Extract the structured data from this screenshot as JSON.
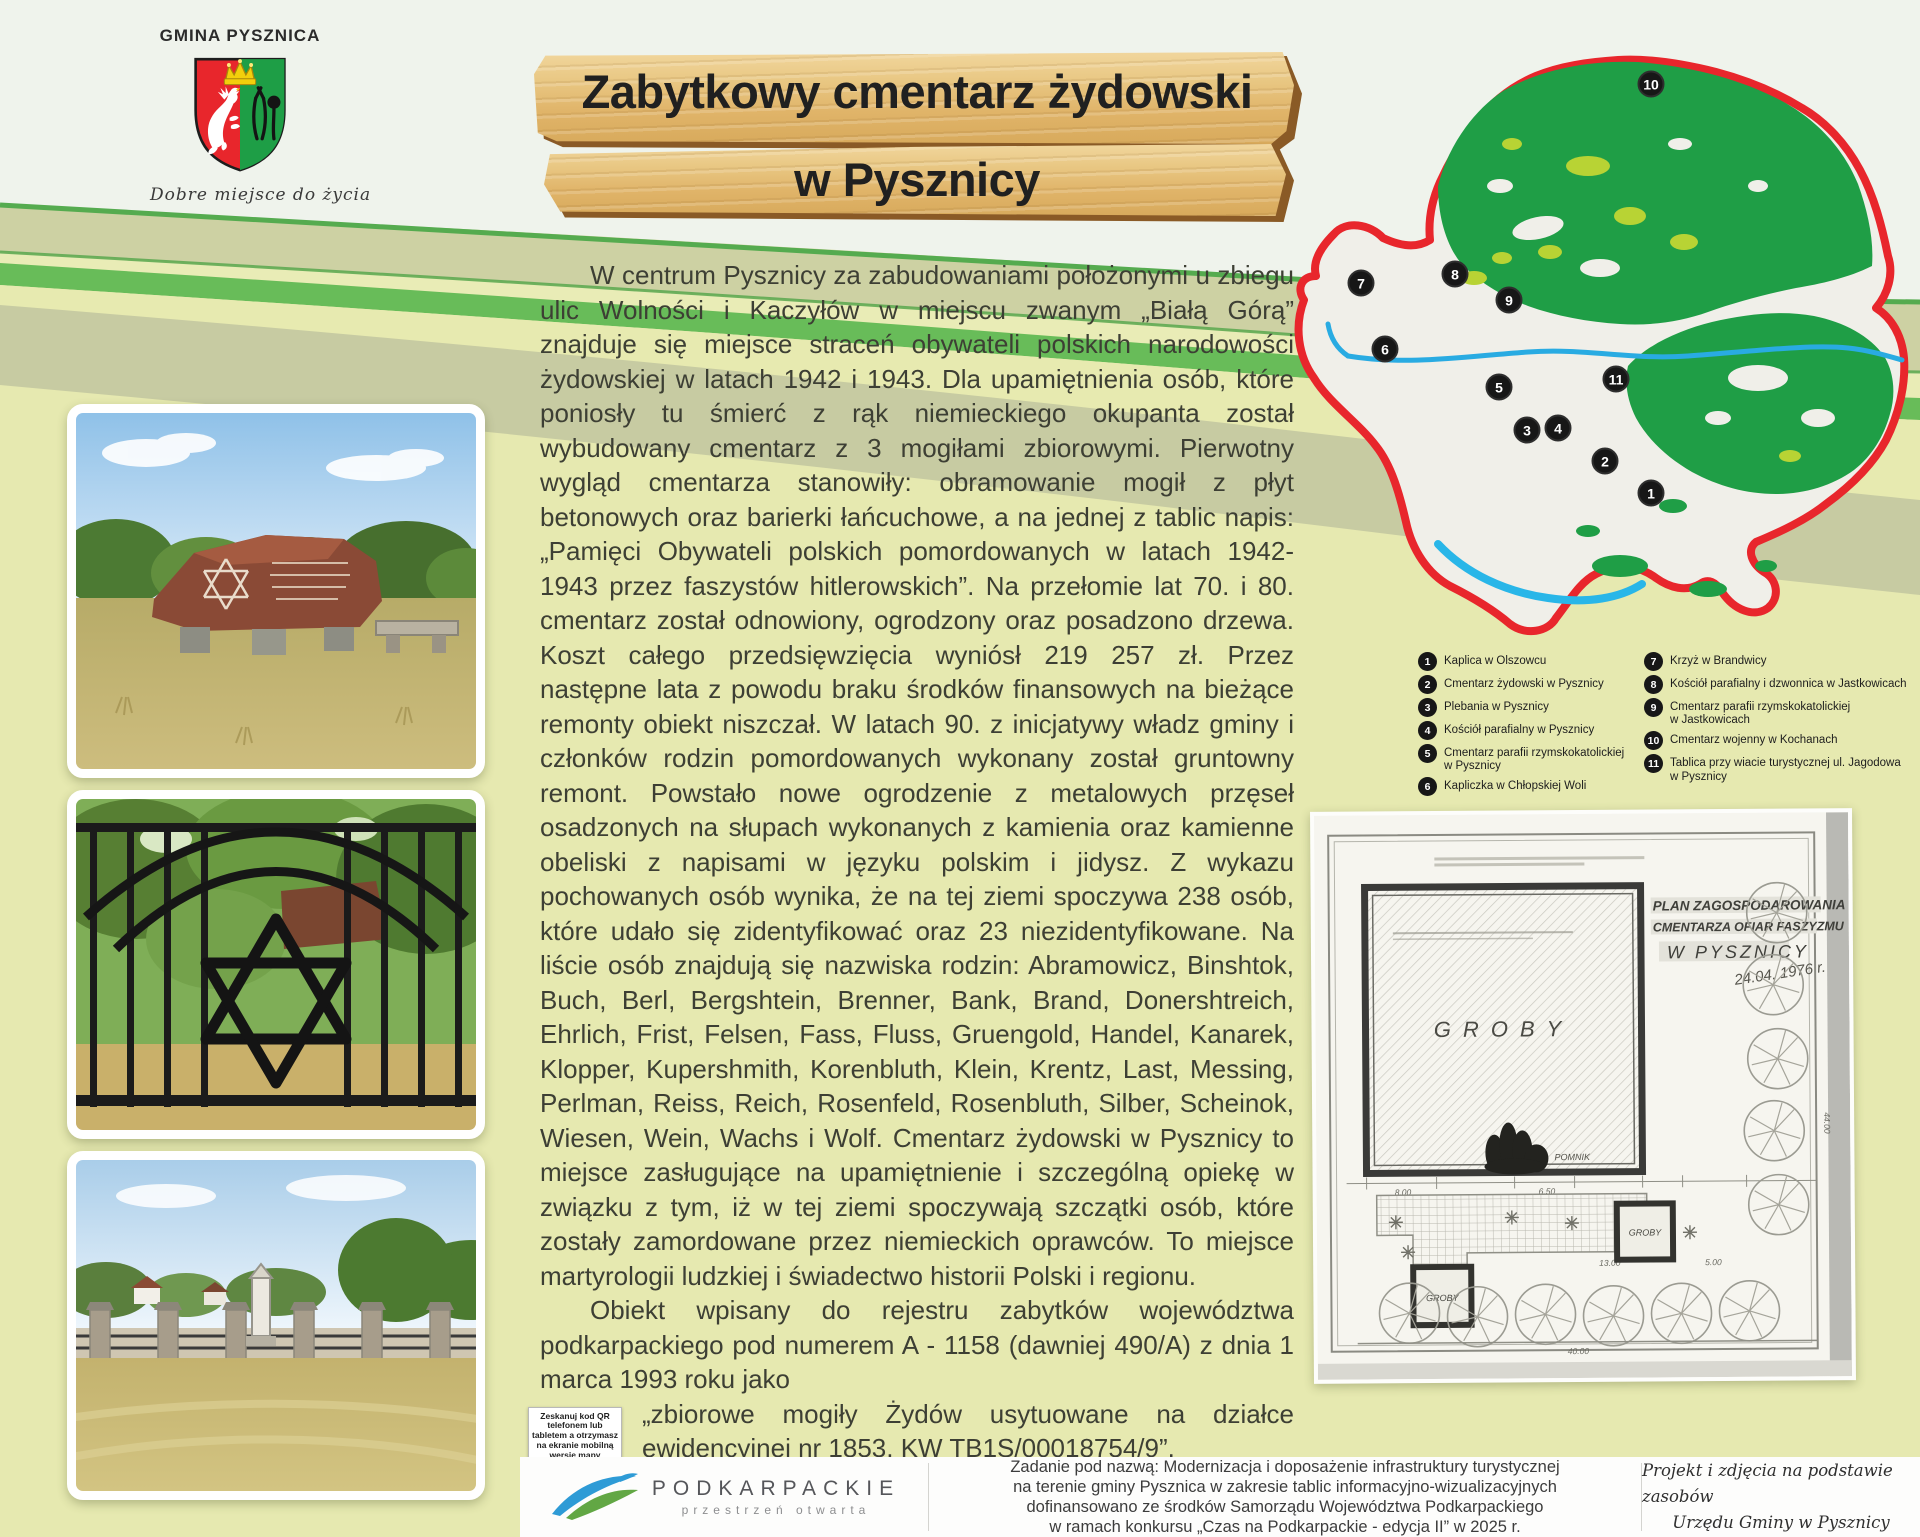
{
  "colors": {
    "accent_red": "#e8262c",
    "forest_green": "#1f9e46",
    "meadow_green": "#b8d334",
    "water_blue": "#29abe2",
    "wood_tan": "#e8c27a",
    "page_base": "#e6e9b0"
  },
  "header": {
    "municipality": "GMINA PYSZNICA",
    "motto": "Dobre miejsce do życia",
    "title_line1": "Zabytkowy cmentarz żydowski",
    "title_line2": "w Pysznicy"
  },
  "map": {
    "markers": [
      {
        "n": "1"
      },
      {
        "n": "2"
      },
      {
        "n": "3"
      },
      {
        "n": "4"
      },
      {
        "n": "5"
      },
      {
        "n": "6"
      },
      {
        "n": "7"
      },
      {
        "n": "8"
      },
      {
        "n": "9"
      },
      {
        "n": "10"
      },
      {
        "n": "11"
      }
    ],
    "legend_col1": [
      {
        "n": "1",
        "label": "Kaplica w Olszowcu",
        "label2": ""
      },
      {
        "n": "2",
        "label": "Cmentarz żydowski w Pysznicy",
        "label2": ""
      },
      {
        "n": "3",
        "label": "Plebania w Pysznicy",
        "label2": ""
      },
      {
        "n": "4",
        "label": "Kościół parafialny w Pysznicy",
        "label2": ""
      },
      {
        "n": "5",
        "label": "Cmentarz parafii rzymskokatolickiej",
        "label2": "w Pysznicy"
      },
      {
        "n": "6",
        "label": "Kapliczka w Chłopskiej Woli",
        "label2": ""
      }
    ],
    "legend_col2": [
      {
        "n": "7",
        "label": "Krzyż w Brandwicy",
        "label2": ""
      },
      {
        "n": "8",
        "label": "Kościół parafialny i dzwonnica w Jastkowicach",
        "label2": ""
      },
      {
        "n": "9",
        "label": "Cmentarz parafii rzymskokatolickiej",
        "label2": "w Jastkowicach"
      },
      {
        "n": "10",
        "label": "Cmentarz wojenny w Kochanach",
        "label2": ""
      },
      {
        "n": "11",
        "label": "Tablica przy wiacie turystycznej ul. Jagodowa w Pysznicy",
        "label2": ""
      }
    ]
  },
  "article": {
    "p1": "W centrum Pysznicy za zabudowaniami położonymi u zbiegu ulic Wolności i Kaczyłów w miejscu zwanym „Białą Górą” znajduje się miejsce straceń obywateli polskich narodowości żydowskiej w latach 1942 i 1943. Dla upamiętnienia osób, które poniosły tu śmierć z rąk niemieckiego okupanta został wybudowany cmentarz z 3 mogiłami zbiorowymi. Pierwotny wygląd cmentarza stanowiły: obramowanie mogił z płyt betonowych oraz barierki łańcuchowe, a na jednej z tablic napis: „Pamięci Obywateli polskich pomordowanych w latach 1942-1943 przez faszystów hitlerowskich”. Na przełomie lat 70. i 80. cmentarz został odnowiony, ogrodzony oraz posadzono drzewa. Koszt całego przedsięwzięcia wyniósł 219 257 zł. Przez następne lata z powodu braku środków finansowych na bieżące remonty obiekt niszczał. W latach 90. z inicjatywy władz gminy i członków rodzin pomordowanych wykonany został gruntowny remont. Powstało nowe ogrodzenie z metalowych przęseł osadzonych na słupach wykonanych z kamienia oraz kamienne obeliski z napisami w języku polskim i jidysz. Z wykazu pochowanych osób wynika, że na tej ziemi spoczywa 238 osób, które udało się zidentyfikować oraz 23 niezidentyfikowane. Na liście osób znajdują się nazwiska rodzin: Abramowicz, Binshtok, Buch, Berl, Bergshtein, Brenner, Bank, Brand, Donershtreich, Ehrlich, Frist, Felsen, Fass, Fluss, Gruengold, Handel, Kanarek, Klopper, Kupershmith, Korenbluth, Klein, Krentz, Last, Messing, Perlman, Reiss, Reich, Rosenfeld, Rosenbluth, Silber, Scheinok, Wiesen, Wein, Wachs i Wolf. Cmentarz żydowski w Pysznicy to miejsce zasługujące na upamiętnienie i szczególną opiekę w związku z tym, iż w tej ziemi spoczywają szczątki osób, które zostały zamordowane przez niemieckich oprawców. To miejsce martyrologii ludzkiej i świadectwo historii Polski i regionu.",
    "p2a": "Obiekt wpisany do rejestru zabytków województwa podkarpackiego pod numerem A - 1158 (dawniej 490/A) z dnia 1 marca 1993 roku jako",
    "p2b": "„zbiorowe mogiły Żydów usytuowane na działce ewidencyjnej nr 1853, KW TB1S/00018754/9”.",
    "owner_label": "Właściciel:",
    "owner_value": " Gmina Pysznica",
    "credit": "Opracowanie tekstu: Beata Biały"
  },
  "qr": {
    "caption": "Zeskanuj kod QR telefonem lub tabletem a otrzymasz na ekranie mobilną wersję mapy"
  },
  "plan": {
    "title1": "PLAN ZAGOSPODAROWANIA",
    "title2": "CMENTARZA OFIAR FASZYZMU",
    "title3": "W PYSZNICY",
    "date": "24.04. 1976 r.",
    "groby": "GROBY",
    "pomnik": "POMNIK",
    "dims": [
      "20.00",
      "8.00",
      "6.50",
      "13.00",
      "5.00",
      "40.00",
      "44.00"
    ]
  },
  "footer": {
    "brand": "PODKARPACKIE",
    "brand_sub": "przestrzeń otwarta",
    "funding_lines": [
      "Zadanie pod nazwą: Modernizacja i doposażenie infrastruktury turystycznej",
      "na terenie gminy Pysznica w zakresie tablic informacyjno-wizualizacyjnych",
      "dofinansowano ze środków Samorządu Województwa Podkarpackiego",
      "w ramach konkursu „Czas na Podkarpackie - edycja II” w 2025 r."
    ],
    "credit_lines": [
      "Projekt i zdjęcia na podstawie zasobów",
      "Urzędu Gminy w Pysznicy"
    ]
  }
}
